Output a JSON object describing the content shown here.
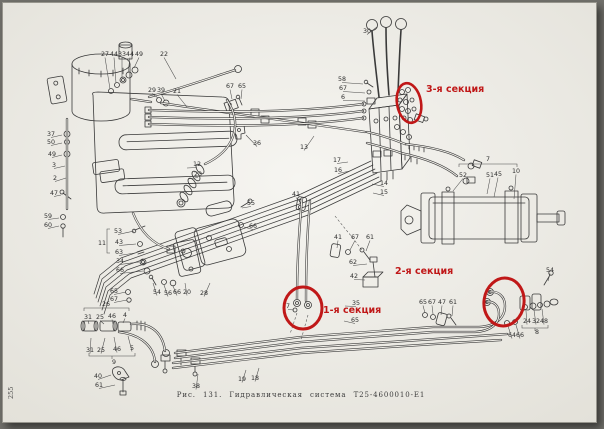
{
  "page_number": "255",
  "caption": "Рис. 131. Гидравлическая система Т25-4600010-Е1",
  "diagram": {
    "ink_color": "#3a3a3a",
    "paper_color": "#f1f0eb",
    "annotation_color": "#c01818",
    "annotations": [
      {
        "id": "3",
        "label": "3-я секция",
        "label_x": 425,
        "label_y": 91,
        "ellipse": {
          "cx": 408,
          "cy": 102,
          "rx": 12,
          "ry": 20,
          "rot": -10,
          "w": 2.6
        }
      },
      {
        "id": "2",
        "label": "2-я секция",
        "label_x": 394,
        "label_y": 273,
        "ellipse": {
          "cx": 503,
          "cy": 301,
          "rx": 20,
          "ry": 24,
          "rot": 8,
          "w": 3
        }
      },
      {
        "id": "1",
        "label": "1-я секция",
        "label_x": 322,
        "label_y": 312,
        "ellipse": {
          "cx": 302,
          "cy": 307,
          "rx": 19,
          "ry": 21,
          "rot": 0,
          "w": 3
        }
      }
    ],
    "callouts": [
      {
        "t": "27",
        "x": 104,
        "y": 55,
        "lx": 109,
        "ly": 88
      },
      {
        "t": "44",
        "x": 113,
        "y": 55,
        "lx": 115,
        "ly": 82
      },
      {
        "t": "33",
        "x": 121,
        "y": 55,
        "lx": 121,
        "ly": 77
      },
      {
        "t": "44",
        "x": 129,
        "y": 55,
        "lx": 127,
        "ly": 72
      },
      {
        "t": "49",
        "x": 138,
        "y": 55,
        "lx": 133,
        "ly": 67
      },
      {
        "t": "22",
        "x": 163,
        "y": 55,
        "lx": 175,
        "ly": 78
      },
      {
        "t": "29",
        "x": 151,
        "y": 91,
        "lx": 157,
        "ly": 97
      },
      {
        "t": "39",
        "x": 160,
        "y": 91,
        "lx": 164,
        "ly": 100
      },
      {
        "t": "21",
        "x": 176,
        "y": 92,
        "lx": 186,
        "ly": 106
      },
      {
        "t": "30",
        "x": 366,
        "y": 32,
        "lx": 376,
        "ly": 26
      },
      {
        "t": "58",
        "x": 341,
        "y": 80,
        "lx": 362,
        "ly": 83
      },
      {
        "t": "67",
        "x": 342,
        "y": 89,
        "lx": 364,
        "ly": 92
      },
      {
        "t": "6",
        "x": 342,
        "y": 98,
        "lx": 364,
        "ly": 100
      },
      {
        "t": "67",
        "x": 229,
        "y": 87,
        "lx": 231,
        "ly": 98
      },
      {
        "t": "65",
        "x": 241,
        "y": 87,
        "lx": 240,
        "ly": 98
      },
      {
        "t": "36",
        "x": 256,
        "y": 144,
        "lx": 245,
        "ly": 134
      },
      {
        "t": "13",
        "x": 303,
        "y": 148,
        "lx": 313,
        "ly": 135
      },
      {
        "t": "37",
        "x": 50,
        "y": 135,
        "lx": 61,
        "ly": 134
      },
      {
        "t": "50",
        "x": 50,
        "y": 143,
        "lx": 61,
        "ly": 142
      },
      {
        "t": "49",
        "x": 51,
        "y": 155,
        "lx": 61,
        "ly": 154
      },
      {
        "t": "3",
        "x": 53,
        "y": 166,
        "lx": 64,
        "ly": 165
      },
      {
        "t": "2",
        "x": 54,
        "y": 179,
        "lx": 65,
        "ly": 177
      },
      {
        "t": "47",
        "x": 53,
        "y": 194,
        "lx": 60,
        "ly": 194
      },
      {
        "t": "59",
        "x": 47,
        "y": 217,
        "lx": 58,
        "ly": 217
      },
      {
        "t": "60",
        "x": 47,
        "y": 226,
        "lx": 58,
        "ly": 225
      },
      {
        "t": "12",
        "x": 196,
        "y": 165,
        "lx": 186,
        "ly": 167
      },
      {
        "t": "23",
        "x": 197,
        "y": 175,
        "lx": 187,
        "ly": 178
      },
      {
        "t": "17",
        "x": 336,
        "y": 161,
        "lx": 347,
        "ly": 161
      },
      {
        "t": "16",
        "x": 337,
        "y": 171,
        "lx": 349,
        "ly": 170
      },
      {
        "t": "14",
        "x": 383,
        "y": 184,
        "lx": 371,
        "ly": 183
      },
      {
        "t": "15",
        "x": 383,
        "y": 193,
        "lx": 372,
        "ly": 192
      },
      {
        "t": "41",
        "x": 295,
        "y": 195,
        "lx": 299,
        "ly": 201
      },
      {
        "t": "55",
        "x": 250,
        "y": 204,
        "lx": 241,
        "ly": 207
      },
      {
        "t": "66",
        "x": 252,
        "y": 227,
        "lx": 243,
        "ly": 226
      },
      {
        "t": "41",
        "x": 337,
        "y": 238,
        "lx": 336,
        "ly": 247
      },
      {
        "t": "67",
        "x": 354,
        "y": 238,
        "lx": 349,
        "ly": 249
      },
      {
        "t": "61",
        "x": 369,
        "y": 238,
        "lx": 365,
        "ly": 250
      },
      {
        "t": "62",
        "x": 352,
        "y": 263,
        "lx": 366,
        "ly": 263
      },
      {
        "t": "42",
        "x": 353,
        "y": 277,
        "lx": 364,
        "ly": 279
      },
      {
        "t": "53",
        "x": 117,
        "y": 232,
        "lx": 133,
        "ly": 230
      },
      {
        "t": "11",
        "x": 101,
        "y": 244
      },
      {
        "t": "43",
        "x": 118,
        "y": 243,
        "lx": 135,
        "ly": 243
      },
      {
        "t": "63",
        "x": 118,
        "y": 253,
        "lx": 134,
        "ly": 252
      },
      {
        "t": "34",
        "x": 119,
        "y": 262,
        "lx": 138,
        "ly": 261
      },
      {
        "t": "66",
        "x": 119,
        "y": 271,
        "lx": 142,
        "ly": 270
      },
      {
        "t": "65",
        "x": 113,
        "y": 292,
        "lx": 125,
        "ly": 291
      },
      {
        "t": "67",
        "x": 113,
        "y": 300,
        "lx": 126,
        "ly": 299
      },
      {
        "t": "26",
        "x": 105,
        "y": 305
      },
      {
        "t": "31",
        "x": 87,
        "y": 318,
        "lx": 88,
        "ly": 323
      },
      {
        "t": "25",
        "x": 99,
        "y": 318,
        "lx": 103,
        "ly": 323
      },
      {
        "t": "46",
        "x": 111,
        "y": 317,
        "lx": 112,
        "ly": 323
      },
      {
        "t": "4",
        "x": 124,
        "y": 316,
        "lx": 122,
        "ly": 322
      },
      {
        "t": "54",
        "x": 156,
        "y": 293,
        "lx": 152,
        "ly": 282
      },
      {
        "t": "56",
        "x": 167,
        "y": 294,
        "lx": 163,
        "ly": 284
      },
      {
        "t": "66",
        "x": 176,
        "y": 293,
        "lx": 172,
        "ly": 285
      },
      {
        "t": "20",
        "x": 186,
        "y": 293,
        "lx": 184,
        "ly": 282
      },
      {
        "t": "28",
        "x": 203,
        "y": 294,
        "lx": 209,
        "ly": 282
      },
      {
        "t": "31",
        "x": 89,
        "y": 351,
        "lx": 90,
        "ly": 337
      },
      {
        "t": "25",
        "x": 100,
        "y": 351,
        "lx": 104,
        "ly": 337
      },
      {
        "t": "46",
        "x": 116,
        "y": 350,
        "lx": 113,
        "ly": 336
      },
      {
        "t": "5",
        "x": 131,
        "y": 349,
        "lx": 127,
        "ly": 335
      },
      {
        "t": "9",
        "x": 113,
        "y": 363
      },
      {
        "t": "40",
        "x": 97,
        "y": 377,
        "lx": 110,
        "ly": 374
      },
      {
        "t": "61",
        "x": 98,
        "y": 386,
        "lx": 114,
        "ly": 384
      },
      {
        "t": "38",
        "x": 195,
        "y": 387,
        "lx": 197,
        "ly": 373
      },
      {
        "t": "19",
        "x": 241,
        "y": 380,
        "lx": 245,
        "ly": 369
      },
      {
        "t": "18",
        "x": 254,
        "y": 379,
        "lx": 258,
        "ly": 367
      },
      {
        "t": "7",
        "x": 487,
        "y": 160
      },
      {
        "t": "52",
        "x": 462,
        "y": 176,
        "lx": 452,
        "ly": 190
      },
      {
        "t": "51",
        "x": 489,
        "y": 176,
        "lx": 486,
        "ly": 193
      },
      {
        "t": "45",
        "x": 497,
        "y": 175,
        "lx": 493,
        "ly": 196
      },
      {
        "t": "10",
        "x": 515,
        "y": 172,
        "lx": 513,
        "ly": 198
      },
      {
        "t": "7",
        "x": 287,
        "y": 307,
        "lx": 293,
        "ly": 309
      },
      {
        "t": "35",
        "x": 355,
        "y": 304,
        "lx": 344,
        "ly": 305
      },
      {
        "t": "65",
        "x": 354,
        "y": 321,
        "lx": 343,
        "ly": 320
      },
      {
        "t": "65",
        "x": 422,
        "y": 303,
        "lx": 424,
        "ly": 312
      },
      {
        "t": "67",
        "x": 431,
        "y": 303,
        "lx": 432,
        "ly": 313
      },
      {
        "t": "47",
        "x": 441,
        "y": 303,
        "lx": 440,
        "ly": 314
      },
      {
        "t": "61",
        "x": 452,
        "y": 303,
        "lx": 451,
        "ly": 315
      },
      {
        "t": "54",
        "x": 549,
        "y": 271,
        "lx": 547,
        "ly": 280
      },
      {
        "t": "24",
        "x": 526,
        "y": 322,
        "lx": 525,
        "ly": 310
      },
      {
        "t": "32",
        "x": 535,
        "y": 322,
        "lx": 533,
        "ly": 309
      },
      {
        "t": "48",
        "x": 543,
        "y": 322,
        "lx": 541,
        "ly": 308
      },
      {
        "t": "8",
        "x": 536,
        "y": 333
      },
      {
        "t": "64",
        "x": 511,
        "y": 336,
        "lx": 507,
        "ly": 325
      },
      {
        "t": "66",
        "x": 519,
        "y": 336,
        "lx": 515,
        "ly": 324
      }
    ]
  }
}
